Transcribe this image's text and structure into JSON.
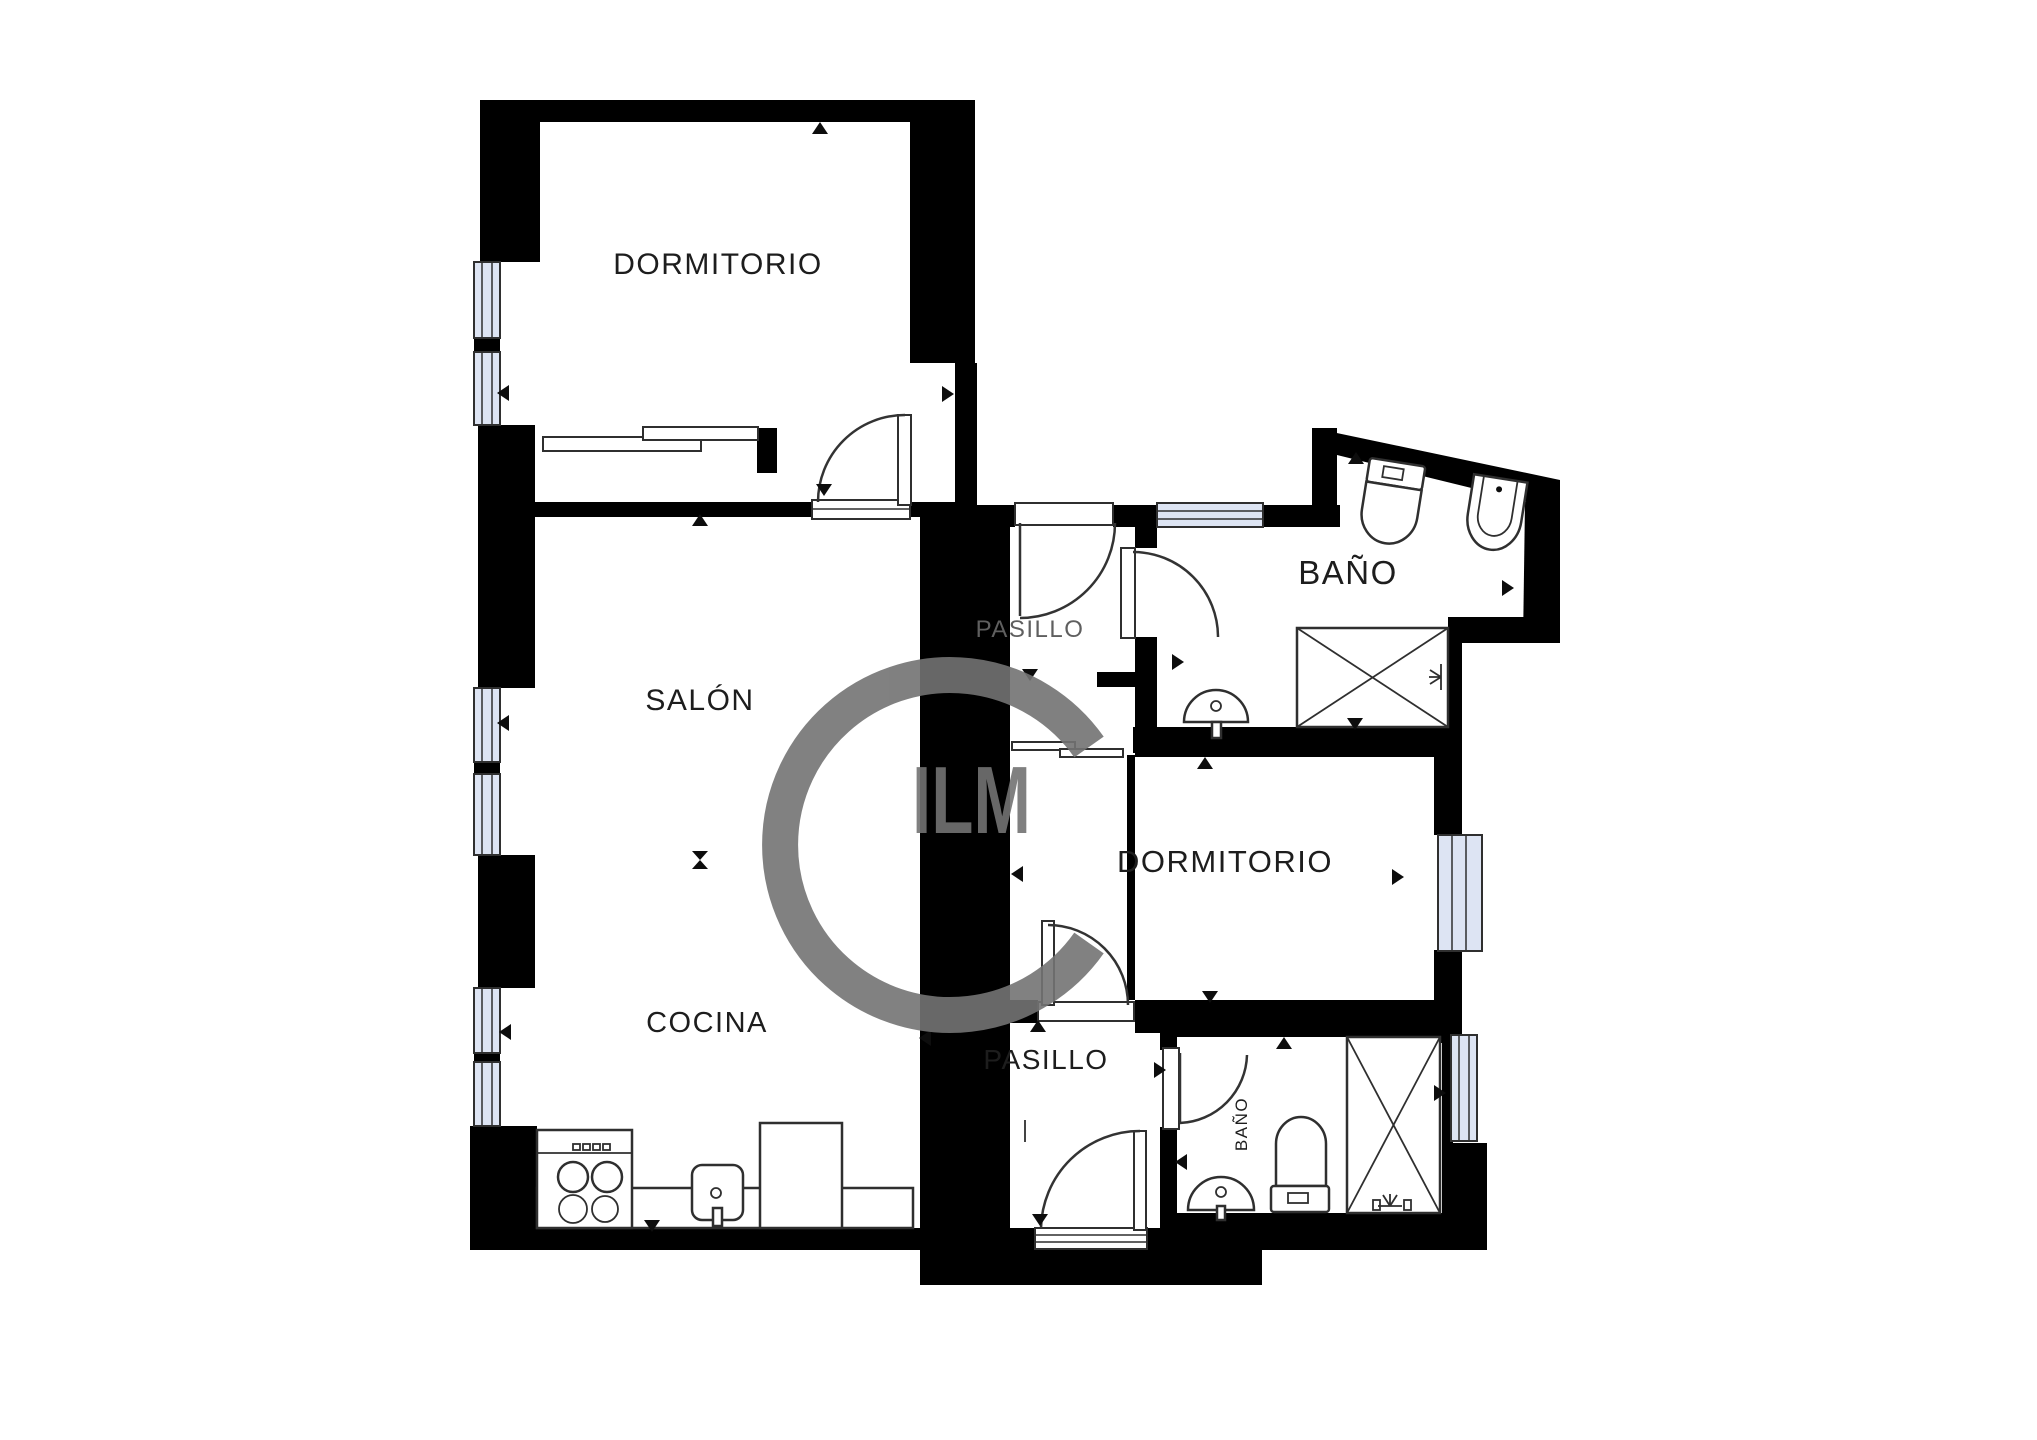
{
  "document": {
    "type": "floor-plan",
    "language": "es"
  },
  "colors": {
    "wall": "#000000",
    "line": "#2f2f2f",
    "window_fill": "#dde4f3",
    "label": "#1d1d1d",
    "label_muted": "#5f5f5f",
    "watermark": "#737373",
    "bg": "#ffffff"
  },
  "rooms": {
    "bedroom_top": {
      "label": "DORMITORIO"
    },
    "living": {
      "label": "SALÓN"
    },
    "kitchen": {
      "label": "COCINA"
    },
    "hall_upper": {
      "label": "PASILLO"
    },
    "bath_upper": {
      "label": "BAÑO"
    },
    "bedroom_right": {
      "label": "DORMITORIO"
    },
    "hall_lower": {
      "label": "PASILLO"
    },
    "bath_lower": {
      "label": "BAÑO"
    }
  },
  "watermark": {
    "text": "ILM"
  },
  "fixtures": [
    "stove-icon",
    "kitchen-sink-icon",
    "counter",
    "toilet-icon",
    "bidet-icon",
    "shower-icon",
    "washbasin-icon",
    "radiator-icon",
    "door-swing",
    "window",
    "sliding-closet-doors",
    "direction-arrow"
  ]
}
